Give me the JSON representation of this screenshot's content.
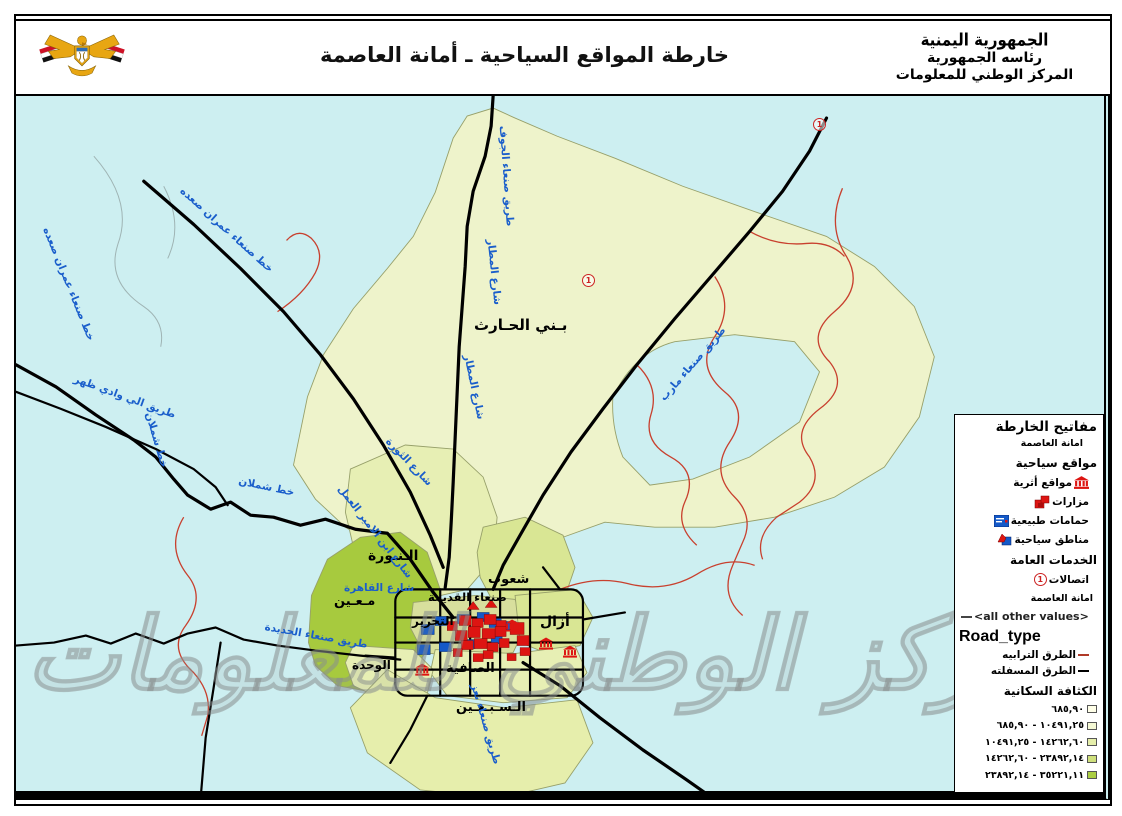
{
  "colors": {
    "map-bg": "#cdeff1",
    "district-pale": "#eef3cb",
    "district-light": "#e7efb4",
    "district-mid": "#d9e694",
    "district-dark": "#a7ca3e",
    "district-tan": "#d8df9d",
    "road-paved": "#000000",
    "road-dirt": "#c8402e",
    "label-road": "#1a5ecb",
    "site-red": "#dd1512",
    "site-blue": "#1459c8"
  },
  "header": {
    "title": "خارطة المواقع السياحية ـ أمانة العاصمة",
    "org_calligraphy": "الجمهورية اليمنية",
    "org_line1": "رئاسه الجمهورية",
    "org_line2": "المركز الوطني للمعلومات"
  },
  "legend": {
    "title": "مفاتيح الخارطة",
    "subtitle": "امانة العاصمة",
    "sections": {
      "tourist": "مواقع سياحية",
      "services": "الخدمات العامة",
      "amanah": "امانة العاصمة",
      "road_type": "Road_type",
      "density": "الكثافة السكانية"
    },
    "tourist_items": [
      {
        "label": "مواقع أثرية"
      },
      {
        "label": "مزارات"
      },
      {
        "label": "حمامات طبيعية"
      },
      {
        "label": "مناطق سياحية"
      }
    ],
    "service_items": [
      {
        "label": "اتصالات"
      }
    ],
    "road_items": [
      {
        "label": "<all other values>",
        "color": "#444444"
      },
      {
        "label": "الطرق الترابيه",
        "color": "#b03a28"
      },
      {
        "label": "الطرق المسفلته",
        "color": "#000000"
      }
    ],
    "density_classes": [
      {
        "range": "٦٨٥,٩٠",
        "color": "#ffffe8"
      },
      {
        "range": "١٠٤٩١,٢٥ - ٦٨٥,٩٠",
        "color": "#f4f8d4"
      },
      {
        "range": "١٤٢٦٢,٦٠ - ١٠٤٩١,٢٥",
        "color": "#e5eeaa"
      },
      {
        "range": "٢٣٨٩٢,١٤ - ١٤٢٦٢,٦٠",
        "color": "#cfe07c"
      },
      {
        "range": "٣٥٢٢١,١١ - ٢٣٨٩٢,١٤",
        "color": "#abce42"
      }
    ]
  },
  "map": {
    "watermark": "المركز الوطني للمعلومات",
    "telecom_symbol": "1",
    "districts": [
      {
        "label": "بـني الحـارث"
      },
      {
        "label": "الـنـورة"
      },
      {
        "label": "شعوب"
      },
      {
        "label": "مـعـين"
      },
      {
        "label": "صنعاء القديمة"
      },
      {
        "label": "التحرير"
      },
      {
        "label": "أزال"
      },
      {
        "label": "الصافية"
      },
      {
        "label": "الوحدة"
      },
      {
        "label": "الـسـبـعـين"
      }
    ],
    "road_labels": [
      {
        "label": "خط صنعاء عمران صعده"
      },
      {
        "label": "خط صنعاء عمران صعده"
      },
      {
        "label": "طريق الي وادي ظهر"
      },
      {
        "label": "خط شملان"
      },
      {
        "label": "خط شملان"
      },
      {
        "label": "شارع ابن الامير العمل"
      },
      {
        "label": "طريق صنعاء الجوف"
      },
      {
        "label": "شارع المطار"
      },
      {
        "label": "شارع المطار"
      },
      {
        "label": "شارع الثورة"
      },
      {
        "label": "طريق صنعاء مارب"
      },
      {
        "label": "شارع القاهرة"
      },
      {
        "label": "طريق صنعاء الحديدة"
      },
      {
        "label": "طريق صنعاء تعز"
      }
    ]
  }
}
